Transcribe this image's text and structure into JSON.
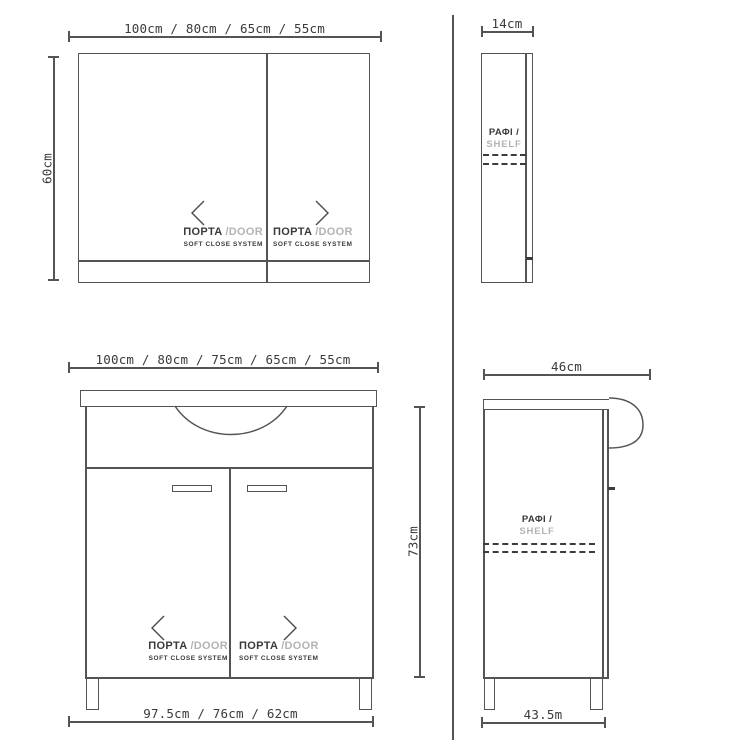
{
  "colors": {
    "line": "#545454",
    "ink": "#3a3a3a",
    "muted": "#b3b3b3"
  },
  "views": {
    "mirror_front": {
      "width_dim": "100cm / 80cm / 65cm / 55cm",
      "height_dim": "60cm",
      "doors": [
        {
          "label_gr": "ΠΟΡΤΑ",
          "label_en": "/DOOR",
          "note": "SOFT CLOSE SYSTEM"
        },
        {
          "label_gr": "ΠΟΡΤΑ",
          "label_en": "/DOOR",
          "note": "SOFT CLOSE SYSTEM"
        }
      ]
    },
    "mirror_side": {
      "depth_dim": "14cm",
      "shelf_label_gr": "ΡΑΦΙ /",
      "shelf_label_en": "SHELF"
    },
    "vanity_front": {
      "width_dim": "100cm / 80cm / 75cm / 65cm / 55cm",
      "height_dim": "73cm",
      "base_width_dim": "97.5cm / 76cm / 62cm",
      "doors": [
        {
          "label_gr": "ΠΟΡΤΑ",
          "label_en": "/DOOR",
          "note": "SOFT CLOSE SYSTEM"
        },
        {
          "label_gr": "ΠΟΡΤΑ",
          "label_en": "/DOOR",
          "note": "SOFT CLOSE SYSTEM"
        }
      ]
    },
    "vanity_side": {
      "depth_dim": "46cm",
      "base_depth_dim": "43.5m",
      "shelf_label_gr": "ΡΑΦΙ /",
      "shelf_label_en": "SHELF"
    }
  }
}
